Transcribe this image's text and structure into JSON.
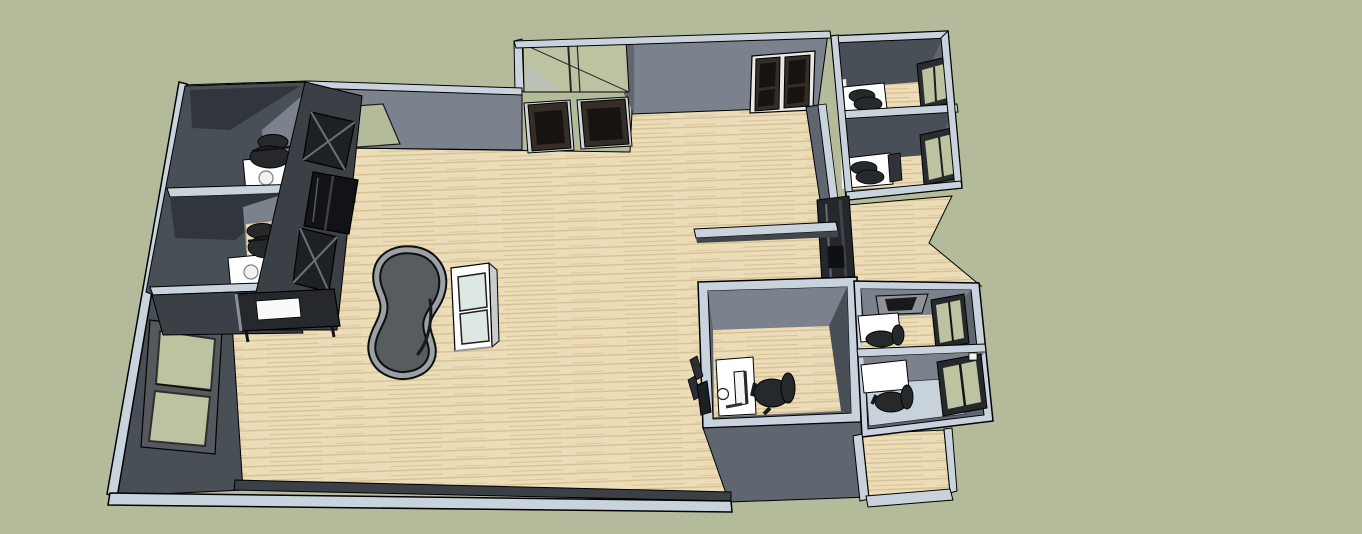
{
  "scene": {
    "description": "SketchUp-style 3D overhead render of an office floor plan: an open hall with wood flooring, a glazed entry vestibule with double doors at top, perimeter private offices with desks, task chairs, monitors and windows, wall-mounted display cases, a kidney-shaped table and a white display cabinet in the open area, low counter wall, and a low perimeter knee wall at the bottom.",
    "viewport": {
      "width": 1362,
      "height": 534
    },
    "rooms": [
      {
        "name": "office-top-left-1",
        "furniture": [
          "white-desk",
          "task-chair"
        ]
      },
      {
        "name": "office-top-left-2",
        "furniture": [
          "white-desk",
          "task-chair"
        ]
      },
      {
        "name": "office-top-right-1",
        "furniture": [
          "white-desk",
          "keyboard",
          "task-chair",
          "window"
        ]
      },
      {
        "name": "office-top-right-2",
        "furniture": [
          "white-desk",
          "keyboard",
          "monitor",
          "task-chair",
          "window"
        ]
      },
      {
        "name": "office-bottom-middle",
        "furniture": [
          "white-desk",
          "monitor",
          "mouse",
          "task-chair",
          "open-door"
        ]
      },
      {
        "name": "office-bottom-right-1",
        "furniture": [
          "dark-top-desk",
          "monitor",
          "task-chair",
          "window"
        ]
      },
      {
        "name": "office-bottom-right-2",
        "furniture": [
          "monitor",
          "task-chair",
          "window",
          "blue-floor"
        ]
      }
    ],
    "open_area_objects": [
      "kidney-shaped-table",
      "white-display-cabinet",
      "wall-display-case-1",
      "wall-display-case-2",
      "wall-display-case-3",
      "dark-display-table",
      "low-counter",
      "dark-shelf-unit",
      "left-wall-windows",
      "entry-vestibule-glazing",
      "vestibule-double-doors",
      "top-wall-double-door",
      "ground-patch-opening"
    ]
  },
  "colors": {
    "bg": "#b4bb9a",
    "floor": "#ecddb9",
    "floor_stripe": "#d8c094",
    "floor_stripe2": "#c9ad7e",
    "cap": "#c9d3dd",
    "wall_light": "#7b828d",
    "wall_mid": "#5f6670",
    "wall_dark": "#494f57",
    "wall_darker": "#3b4047",
    "wall_darkest": "#2d3137",
    "glass_green": "#bdc3a1",
    "glass_pale": "#dde8e2",
    "blue_floor": "#c7d2da",
    "white": "#ffffff",
    "chair": "#26292c",
    "door_panel": "#352e26",
    "door_dark": "#171310",
    "shelf": "#24282d",
    "keyboard_tan": "#d9cba6",
    "table_rim": "#9ba0a4",
    "table_top": "#575c61"
  }
}
